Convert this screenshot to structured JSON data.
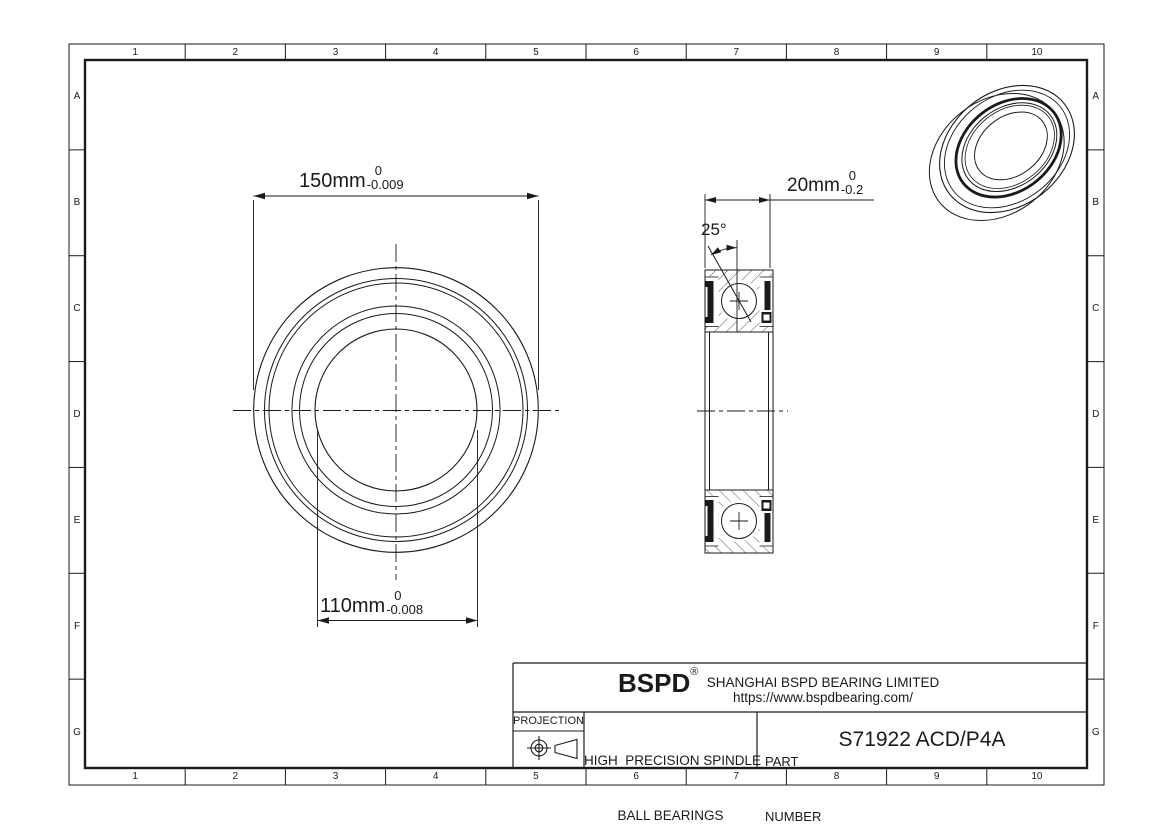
{
  "sheet": {
    "grid": {
      "columns": [
        "1",
        "2",
        "3",
        "4",
        "5",
        "6",
        "7",
        "8",
        "9",
        "10"
      ],
      "rows": [
        "A",
        "B",
        "C",
        "D",
        "E",
        "F",
        "G"
      ]
    }
  },
  "front_view": {
    "od_dim": {
      "value": "150mm",
      "tol_upper": "0",
      "tol_lower": "-0.009"
    },
    "bore_dim": {
      "value": "110mm",
      "tol_upper": "0",
      "tol_lower": "-0.008"
    }
  },
  "section_view": {
    "width_dim": {
      "value": "20mm",
      "tol_upper": "0",
      "tol_lower": "-0.2"
    },
    "contact_angle": "25°"
  },
  "title_block": {
    "logo": "BSPD",
    "logo_reg": "®",
    "company": "SHANGHAI BSPD BEARING LIMITED",
    "website": "https://www.bspdbearing.com/",
    "projection_label": "PROJECTION",
    "product_line1": "HIGH  PRECISION SPINDLE",
    "product_line2": "BALL BEARINGS",
    "part_label_line1": "PART",
    "part_label_line2": "NUMBER",
    "part_number": "S71922 ACD/P4A"
  },
  "colors": {
    "line": "#1a1a1a",
    "hatch": "#3d3d3d",
    "background": "#ffffff"
  }
}
